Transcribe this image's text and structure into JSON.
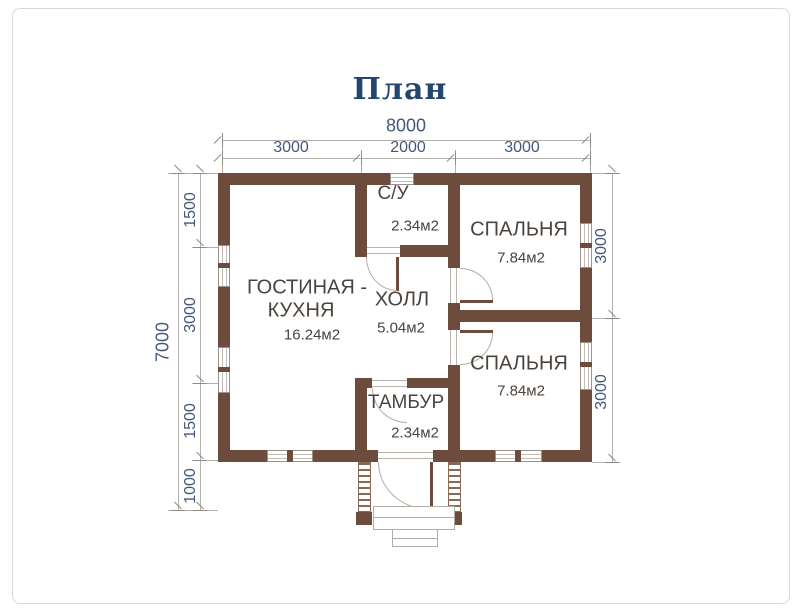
{
  "title": "План",
  "dims": {
    "top_total": "8000",
    "top_seg_1": "3000",
    "top_seg_2": "2000",
    "top_seg_3": "3000",
    "left_total": "7000",
    "left_seg_1": "1500",
    "left_seg_2": "3000",
    "left_seg_3": "1500",
    "left_seg_4": "1000",
    "right_seg_1": "3000",
    "right_seg_2": "3000"
  },
  "rooms": {
    "su": {
      "name": "С/У",
      "area": "2.34м2"
    },
    "bedroom1": {
      "name": "СПАЛЬНЯ",
      "area": "7.84м2"
    },
    "living": {
      "name_line1": "ГОСТИНАЯ -",
      "name_line2": "КУХНЯ",
      "area": "16.24м2"
    },
    "hall": {
      "name": "ХОЛЛ",
      "area": "5.04м2"
    },
    "bedroom2": {
      "name": "СПАЛЬНЯ",
      "area": "7.84м2"
    },
    "tambur": {
      "name": "ТАМБУР",
      "area": "2.34м2"
    }
  },
  "colors": {
    "wall": "#6d4c3e",
    "title_text": "#24466e",
    "dimension_text": "#44587a",
    "room_text": "#4b443e",
    "dimension_line": "#b5b1ad"
  }
}
